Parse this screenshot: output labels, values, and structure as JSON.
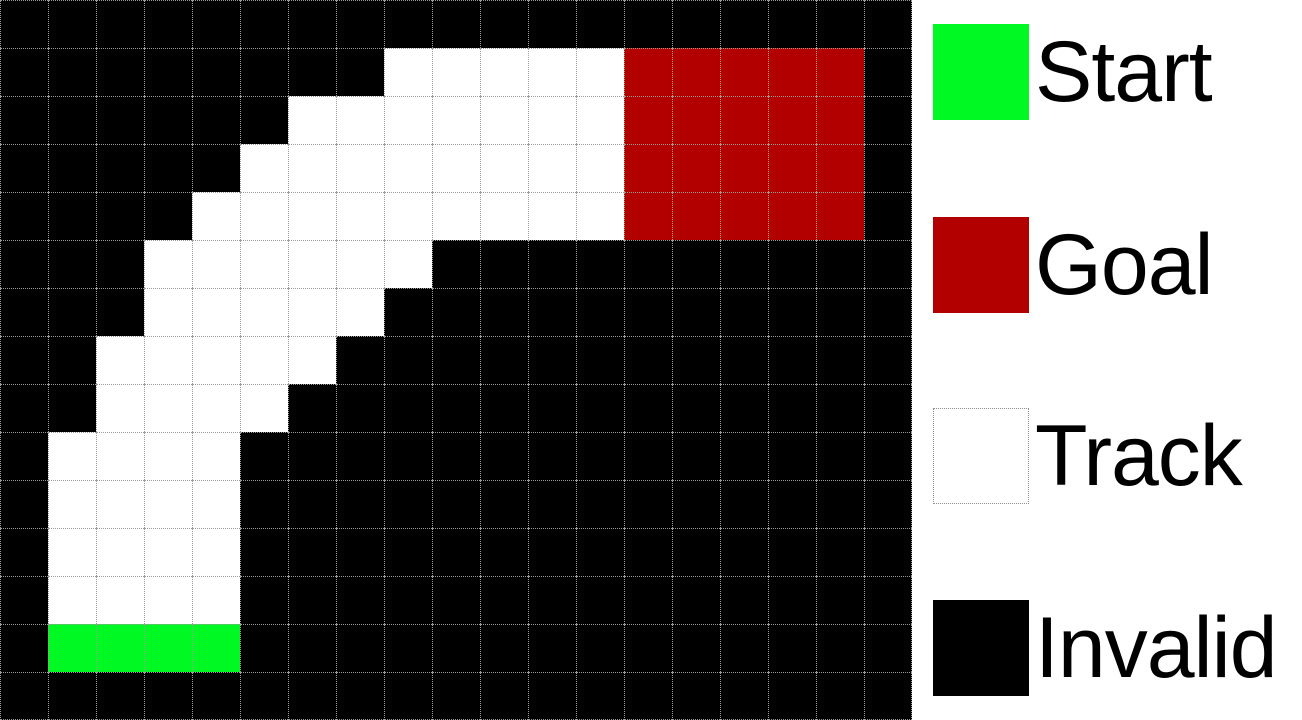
{
  "figure": {
    "description": "Racetrack grid world with start, goal, track and invalid cells"
  },
  "colors": {
    "start": "#00f923",
    "goal": "#b20000",
    "track": "#ffffff",
    "invalid": "#000000",
    "grid_line": "#9c9c9c",
    "panel_background": "#ffffff",
    "label_text": "#000000"
  },
  "grid": {
    "rows": 15,
    "cols": 19,
    "cell_size_px": 48,
    "cell_types": {
      "B": "invalid",
      "T": "track",
      "S": "start",
      "G": "goal"
    },
    "cells": [
      "BBBBBBBBBBBBBBBBBBB",
      "BBBBBBBBTTTTTGGGGGB",
      "BBBBBBTTTTTTTGGGGGB",
      "BBBBBTTTTTTTTGGGGGB",
      "BBBBTTTTTTTTTGGGGGB",
      "BBBTTTTTTBBBBBBBBBB",
      "BBBTTTTTBBBBBBBBBBB",
      "BBTTTTTBBBBBBBBBBBB",
      "BBTTTTBBBBBBBBBBBBB",
      "BTTTTBBBBBBBBBBBBBB",
      "BTTTTBBBBBBBBBBBBBB",
      "BTTTTBBBBBBBBBBBBBB",
      "BTTTTBBBBBBBBBBBBBB",
      "BSSSSBBBBBBBBBBBBBB",
      "BBBBBBBBBBBBBBBBBBB"
    ]
  },
  "legend": {
    "items": [
      {
        "id": "start",
        "label": "Start",
        "swatch": "start"
      },
      {
        "id": "goal",
        "label": "Goal",
        "swatch": "goal"
      },
      {
        "id": "track",
        "label": "Track",
        "swatch": "track"
      },
      {
        "id": "invalid",
        "label": "Invalid",
        "swatch": "invalid"
      }
    ]
  }
}
